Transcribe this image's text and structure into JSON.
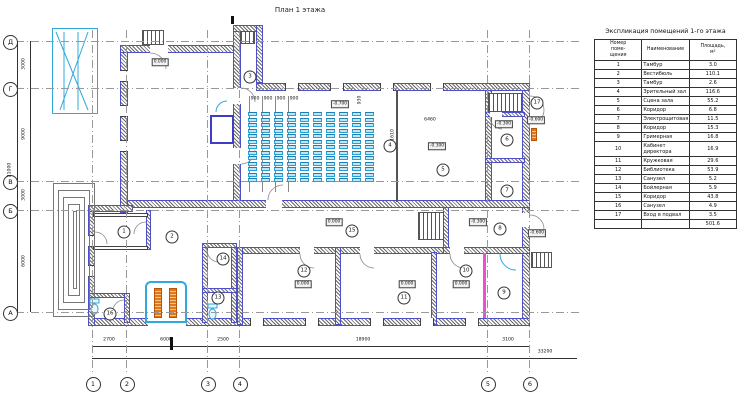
{
  "drawing": {
    "title": "План 1 этажа"
  },
  "schedule": {
    "title": "Экспликация помещений 1-го этажа",
    "col_num": "Номер\nпоме-\nщения",
    "col_name": "Наименование",
    "col_area": "Площадь,\nм²",
    "rows": [
      [
        "1",
        "Тамбур",
        "3.0"
      ],
      [
        "2",
        "Вестибюль",
        "110.1"
      ],
      [
        "3",
        "Тамбур",
        "2.6"
      ],
      [
        "4",
        "Зрительный зал",
        "116.6"
      ],
      [
        "5",
        "Сцена зала",
        "55.2"
      ],
      [
        "6",
        "Коридор",
        "6.8"
      ],
      [
        "7",
        "Электрощитовая",
        "11.5"
      ],
      [
        "8",
        "Коридор",
        "15.3"
      ],
      [
        "9",
        "Гримерная",
        "16.8"
      ],
      [
        "10",
        "Кабинет директора",
        "16.9"
      ],
      [
        "11",
        "Кружковая",
        "29.6"
      ],
      [
        "12",
        "Библиотека",
        "53.9"
      ],
      [
        "13",
        "Санузел",
        "5.2"
      ],
      [
        "14",
        "Бойлерная",
        "5.9"
      ],
      [
        "15",
        "Коридор",
        "43.8"
      ],
      [
        "16",
        "Санузел",
        "4.9"
      ],
      [
        "17",
        "Вход в подвал",
        "3.5"
      ]
    ],
    "total": "501.6"
  },
  "plan": {
    "axis_cols": [
      {
        "label": "1",
        "x": 92
      },
      {
        "label": "2",
        "x": 126
      },
      {
        "label": "3",
        "x": 207
      },
      {
        "label": "4",
        "x": 239
      },
      {
        "label": "5",
        "x": 487
      },
      {
        "label": "6",
        "x": 529
      }
    ],
    "axis_rows": [
      {
        "label": "Д",
        "y": 41
      },
      {
        "label": "Г",
        "y": 88
      },
      {
        "label": "В",
        "y": 181
      },
      {
        "label": "Б",
        "y": 210
      },
      {
        "label": "А",
        "y": 312
      }
    ],
    "room_markers": [
      {
        "n": "1",
        "x": 124,
        "y": 232
      },
      {
        "n": "2",
        "x": 172,
        "y": 237
      },
      {
        "n": "3",
        "x": 250,
        "y": 77
      },
      {
        "n": "4",
        "x": 390,
        "y": 146
      },
      {
        "n": "5",
        "x": 443,
        "y": 170
      },
      {
        "n": "6",
        "x": 507,
        "y": 140
      },
      {
        "n": "7",
        "x": 507,
        "y": 191
      },
      {
        "n": "8",
        "x": 500,
        "y": 229
      },
      {
        "n": "9",
        "x": 504,
        "y": 293
      },
      {
        "n": "10",
        "x": 466,
        "y": 271
      },
      {
        "n": "11",
        "x": 404,
        "y": 298
      },
      {
        "n": "12",
        "x": 304,
        "y": 271
      },
      {
        "n": "13",
        "x": 218,
        "y": 298
      },
      {
        "n": "14",
        "x": 223,
        "y": 259
      },
      {
        "n": "15",
        "x": 352,
        "y": 231
      },
      {
        "n": "16",
        "x": 110,
        "y": 314
      },
      {
        "n": "17",
        "x": 537,
        "y": 103
      }
    ],
    "elevation_markers": [
      {
        "t": "0.000",
        "x": 160,
        "y": 62
      },
      {
        "t": "-0.700",
        "x": 340,
        "y": 104
      },
      {
        "t": "-0.300",
        "x": 437,
        "y": 146
      },
      {
        "t": "-0.300",
        "x": 504,
        "y": 124
      },
      {
        "t": "-0.600",
        "x": 536,
        "y": 120
      },
      {
        "t": "0.000",
        "x": 334,
        "y": 222
      },
      {
        "t": "-0.300",
        "x": 478,
        "y": 222
      },
      {
        "t": "-0.600",
        "x": 537,
        "y": 233
      },
      {
        "t": "0.000",
        "x": 303,
        "y": 284
      },
      {
        "t": "0.000",
        "x": 407,
        "y": 284
      },
      {
        "t": "0.000",
        "x": 461,
        "y": 284
      }
    ],
    "dim_labels": [
      {
        "t": "2700",
        "x": 109,
        "y": 340
      },
      {
        "t": "6000",
        "x": 166,
        "y": 340
      },
      {
        "t": "2500",
        "x": 223,
        "y": 340
      },
      {
        "t": "18900",
        "x": 363,
        "y": 340
      },
      {
        "t": "3100",
        "x": 508,
        "y": 340
      },
      {
        "t": "33200",
        "x": 545,
        "y": 352
      },
      {
        "t": "3000",
        "x": 24,
        "y": 64,
        "r": 1
      },
      {
        "t": "9000",
        "x": 24,
        "y": 134,
        "r": 1
      },
      {
        "t": "3000",
        "x": 24,
        "y": 195,
        "r": 1
      },
      {
        "t": "6000",
        "x": 24,
        "y": 261,
        "r": 1
      },
      {
        "t": "21000",
        "x": 10,
        "y": 170,
        "r": 1
      },
      {
        "t": "900",
        "x": 255,
        "y": 99
      },
      {
        "t": "900",
        "x": 268,
        "y": 99
      },
      {
        "t": "900",
        "x": 281,
        "y": 99
      },
      {
        "t": "900",
        "x": 294,
        "y": 99
      },
      {
        "t": "6460",
        "x": 430,
        "y": 120
      },
      {
        "t": "930",
        "x": 360,
        "y": 100,
        "r": 1
      },
      {
        "t": "1610",
        "x": 393,
        "y": 135,
        "r": 1
      }
    ],
    "seats": {
      "x": 248,
      "y": 112,
      "cols": 10,
      "rows": 13,
      "pitch_x": 13,
      "pitch_y": 5.5,
      "w": 9,
      "h": 4
    },
    "colors": {
      "wall_edge": "#5050c6",
      "cyan": "#2fa8dc",
      "orange": "#e07818",
      "magenta": "#ee4fd2"
    }
  }
}
